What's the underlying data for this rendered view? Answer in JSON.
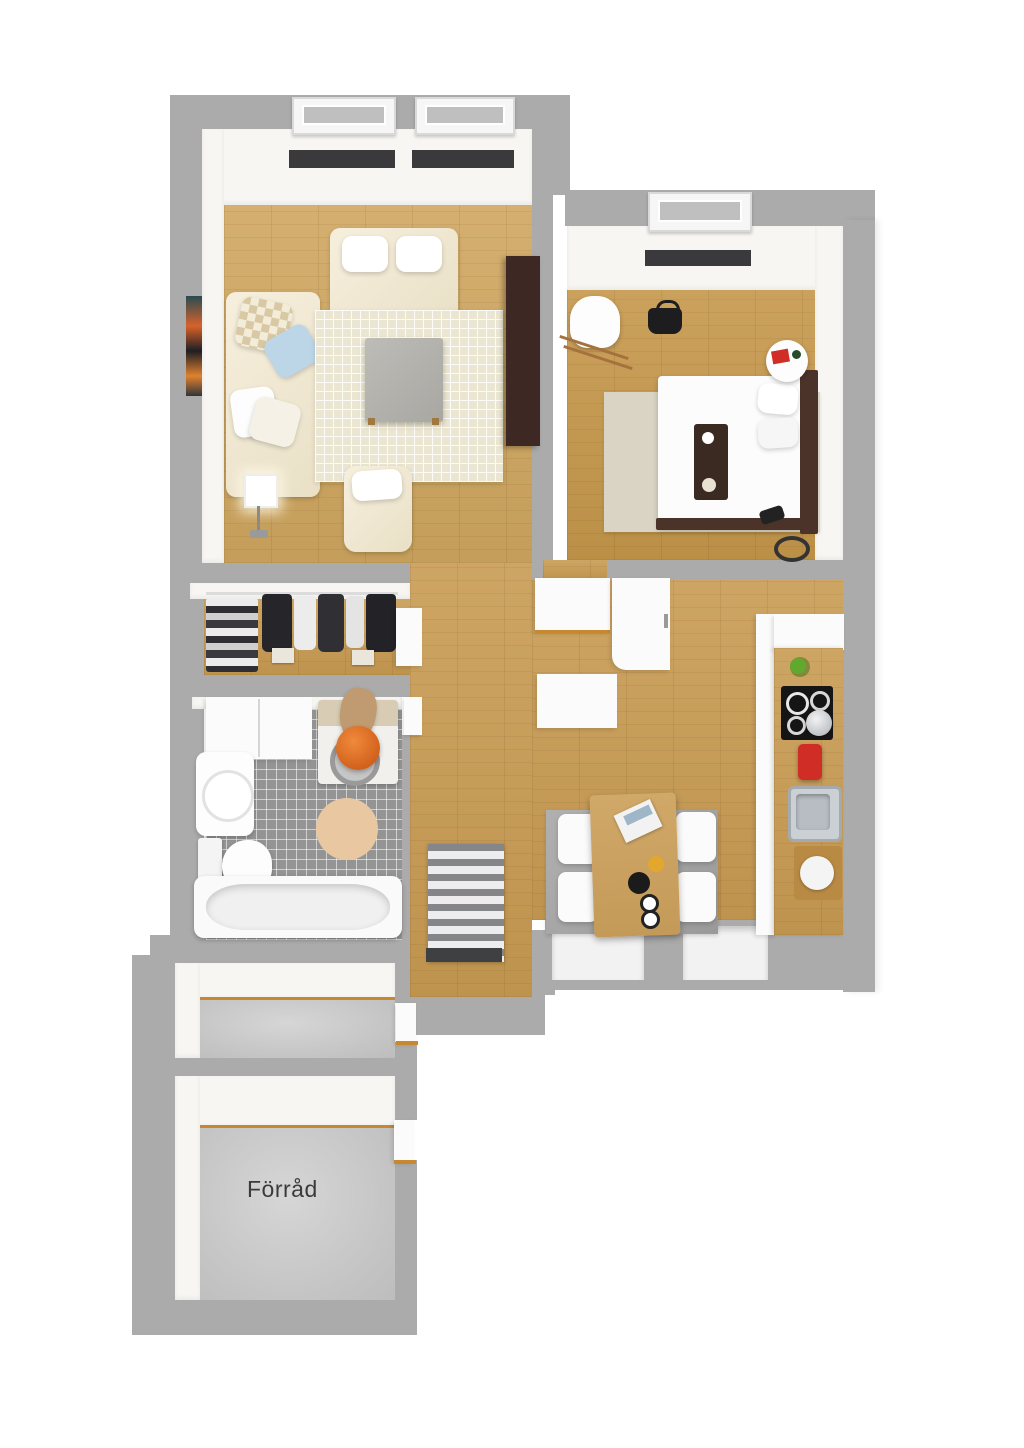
{
  "title": "3D apartment floor plan",
  "labels": {
    "storage": "Förråd"
  },
  "palette": {
    "wall": "#ababab",
    "inner_face": "#f7f6f2",
    "wood_floor": "#cfa65f",
    "wood_floor_kitchen": "#c89b52",
    "wood_floor_bedroom": "#c5974a",
    "bathroom_tile": "#949494",
    "concrete": "#c9c9c9",
    "rug_living": "#eae6d1",
    "rug_bedroom": "#d9d4c4",
    "rug_dining": "#a6a6a6",
    "sofa_cream": "#f1e9d6",
    "tv_cabinet_brown": "#3d2823",
    "bed_frame_brown": "#4b3329",
    "threshold_trim": "#c8882f",
    "window_sill_dark": "#3a3a3c",
    "accent_orange": "#e8732a",
    "accent_red": "#cf2d26",
    "accent_green": "#63a82e",
    "label_text": "#3b3b3b"
  },
  "rooms": [
    {
      "id": "living-room",
      "floor": "wood"
    },
    {
      "id": "bedroom",
      "floor": "wood"
    },
    {
      "id": "closet",
      "floor": "wood"
    },
    {
      "id": "bathroom",
      "floor": "tile"
    },
    {
      "id": "kitchen-dining",
      "floor": "wood"
    },
    {
      "id": "entry-hall",
      "floor": "wood"
    },
    {
      "id": "storage-1",
      "floor": "concrete"
    },
    {
      "id": "storage-2",
      "floor": "concrete",
      "label": "Förråd"
    }
  ]
}
